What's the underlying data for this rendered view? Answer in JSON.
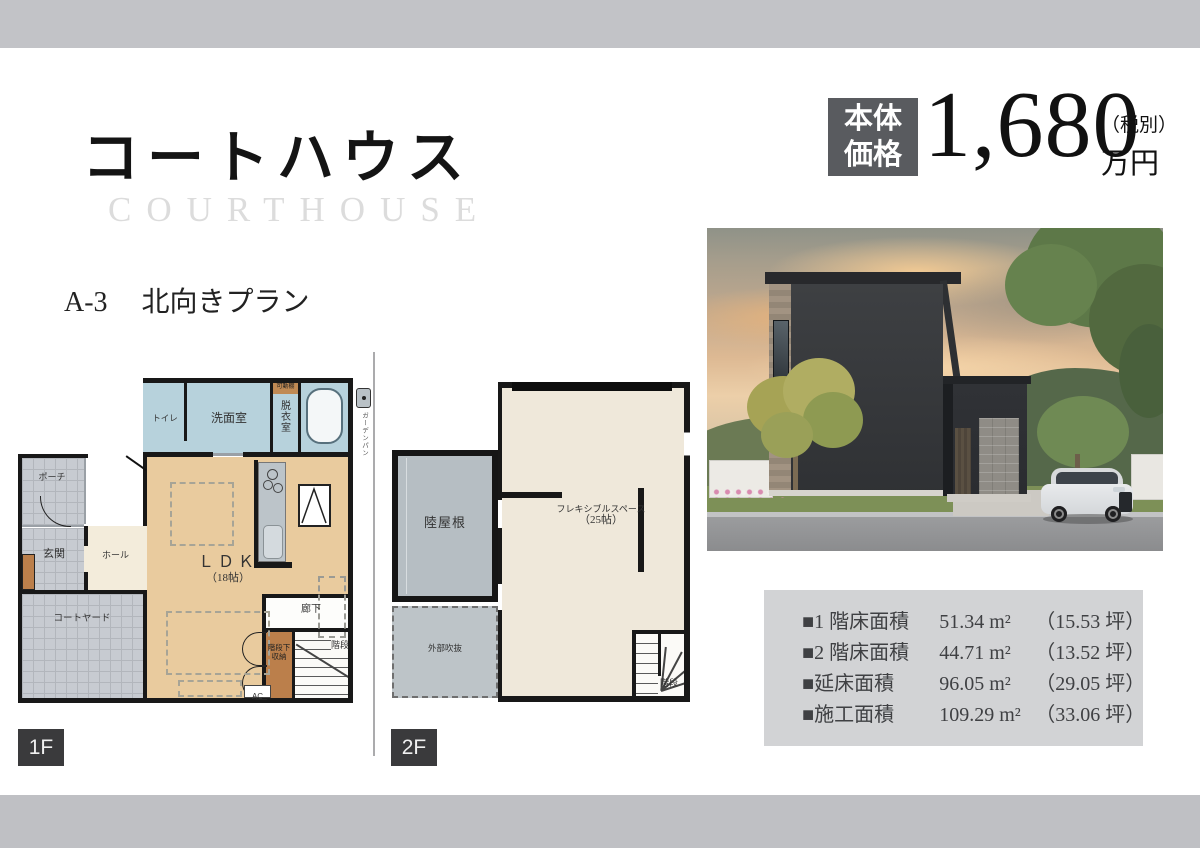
{
  "header": {
    "title_ja": "コートハウス",
    "title_en": "COURTHOUSE",
    "plan_code": "A-3",
    "plan_name": "北向きプラン"
  },
  "price": {
    "label_top": "本体",
    "label_bottom": "価格",
    "amount": "1,680",
    "tax_note": "（税別）",
    "unit": "万円"
  },
  "floor1": {
    "tag": "1F",
    "rooms": {
      "toilet": "トイレ",
      "washroom": "洗面室",
      "dressing_room": "脱衣室",
      "movable_shelf": "可動棚",
      "garden_pan": "ガーデンパン",
      "porch": "ポーチ",
      "entrance": "玄関",
      "hall": "ホール",
      "courtyard": "コートヤード",
      "ldk": "ＬＤＫ",
      "ldk_size": "（18帖）",
      "corridor": "廊下",
      "stair_storage_line1": "階段下",
      "stair_storage_line2": "収納",
      "stairs": "階段",
      "ac": "AC"
    }
  },
  "floor2": {
    "tag": "2F",
    "rooms": {
      "flat_roof": "陸屋根",
      "open_void": "外部吹抜",
      "flex_space": "フレキシブルスペース",
      "flex_size": "（25帖）",
      "stairs": "階段"
    }
  },
  "areas": {
    "items": [
      {
        "label": "■1 階床面積",
        "value": "51.34 m²",
        "tsubo": "（15.53 坪）"
      },
      {
        "label": "■2 階床面積",
        "value": "44.71 m²",
        "tsubo": "（13.52 坪）"
      },
      {
        "label": "■延床面積",
        "value": "96.05 m²",
        "tsubo": "（29.05 坪）"
      },
      {
        "label": "■施工面積",
        "value": "109.29 m²",
        "tsubo": "（33.06 坪）"
      }
    ]
  },
  "colors": {
    "top_bar": "#c2c3c7",
    "price_box": "#595b5f",
    "floor_tag": "#3a3a3c",
    "wet_room": "#b7d2dc",
    "ldk": "#e9cb9e",
    "tile": "#c7cbd1",
    "hall": "#f3ecdb",
    "storage_brown": "#bb7f4b",
    "flat_roof": "#b6bec3",
    "flex_space": "#efe8da"
  }
}
